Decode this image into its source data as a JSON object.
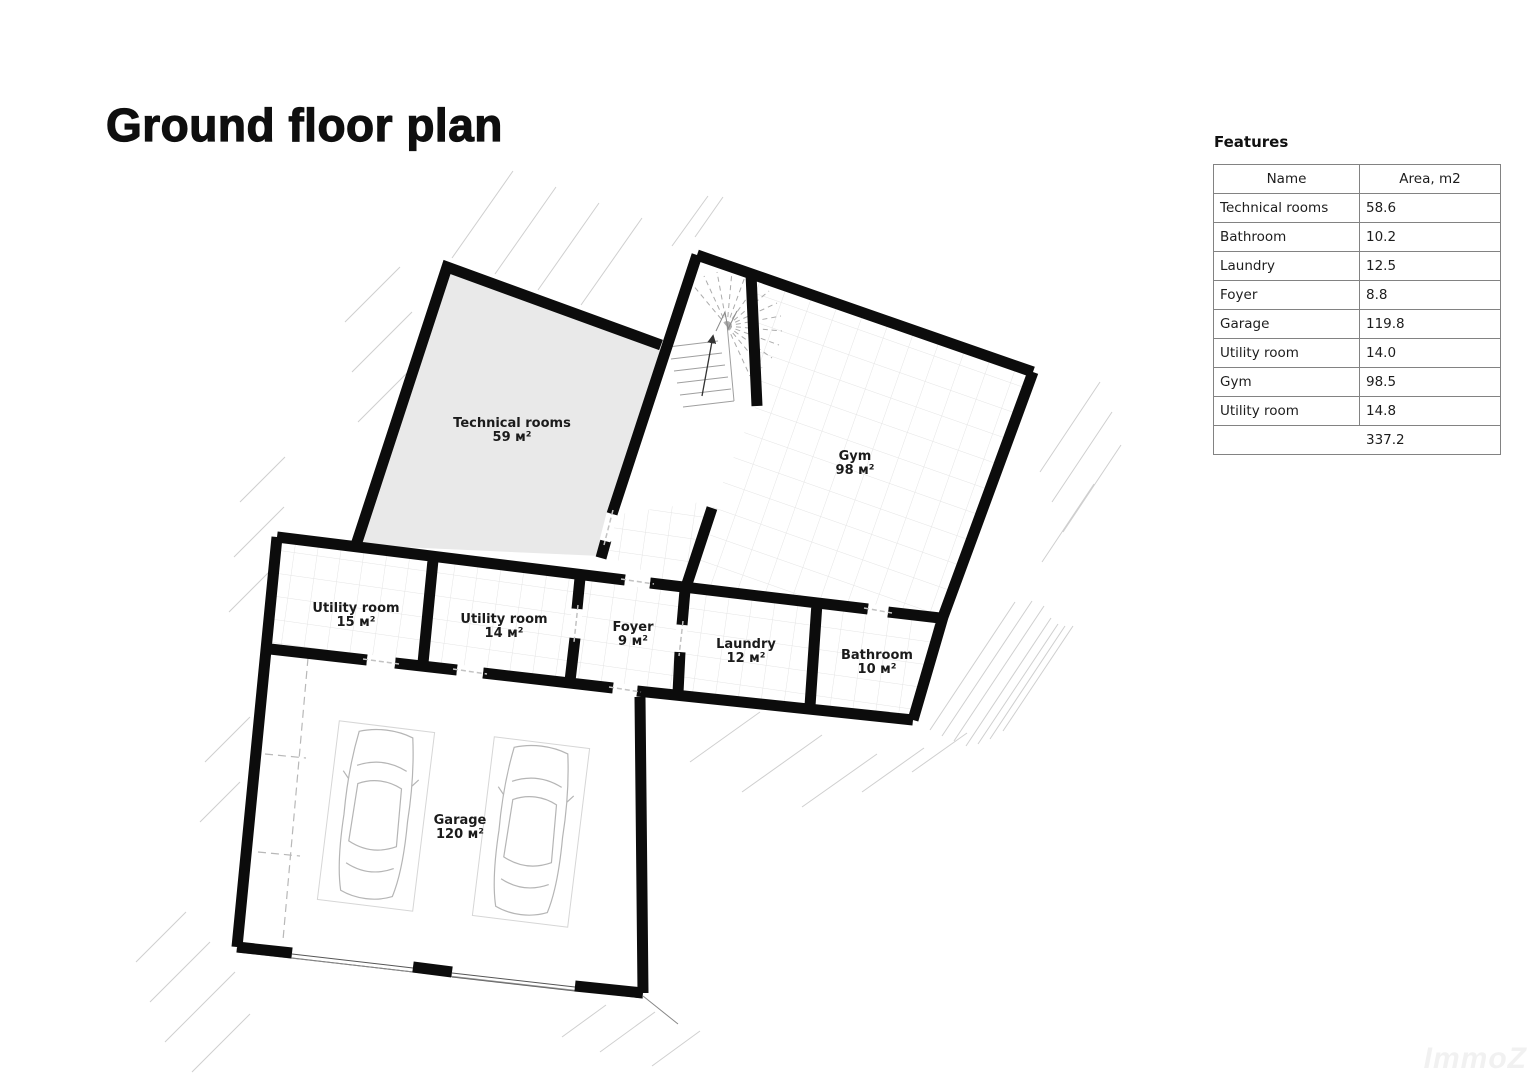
{
  "page": {
    "title": "Ground floor plan",
    "watermark": "ImmoZ"
  },
  "features": {
    "heading": "Features",
    "columns": [
      "Name",
      "Area, m2"
    ],
    "rows": [
      [
        "Technical rooms",
        "58.6"
      ],
      [
        "Bathroom",
        "10.2"
      ],
      [
        "Laundry",
        "12.5"
      ],
      [
        "Foyer",
        "8.8"
      ],
      [
        "Garage",
        "119.8"
      ],
      [
        "Utility room",
        "14.0"
      ],
      [
        "Gym",
        "98.5"
      ],
      [
        "Utility room",
        "14.8"
      ]
    ],
    "total": "337.2"
  },
  "plan": {
    "rooms": [
      {
        "name": "Technical rooms",
        "area_label": "59 м²",
        "label_x": 512,
        "label_y": 427
      },
      {
        "name": "Gym",
        "area_label": "98 м²",
        "label_x": 855,
        "label_y": 460
      },
      {
        "name": "Utility room",
        "area_label": "15 м²",
        "label_x": 356,
        "label_y": 612
      },
      {
        "name": "Utility room",
        "area_label": "14 м²",
        "label_x": 504,
        "label_y": 623
      },
      {
        "name": "Foyer",
        "area_label": "9 м²",
        "label_x": 633,
        "label_y": 631
      },
      {
        "name": "Laundry",
        "area_label": "12 м²",
        "label_x": 746,
        "label_y": 648
      },
      {
        "name": "Bathroom",
        "area_label": "10 м²",
        "label_x": 877,
        "label_y": 659
      },
      {
        "name": "Garage",
        "area_label": "120 м²",
        "label_x": 460,
        "label_y": 824
      }
    ]
  }
}
